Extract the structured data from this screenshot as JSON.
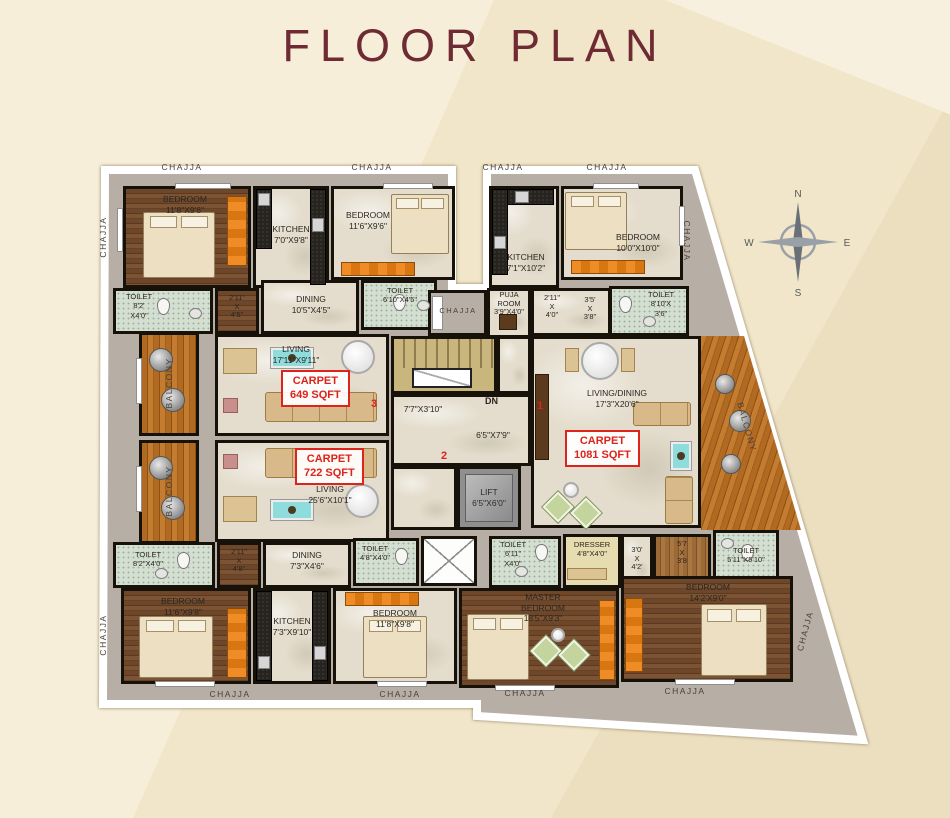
{
  "page": {
    "title": "FLOOR PLAN"
  },
  "labels": {
    "chajja": "CHAJJA",
    "balcony": "BALCONY"
  },
  "compass": {
    "n": "N",
    "e": "E",
    "s": "S",
    "w": "W"
  },
  "core": {
    "dn": "DN",
    "lift_name": "LIFT",
    "lift_dims": "6'5\"X6'0\"",
    "lobby1": "7'7\"X3'10\"",
    "lobby2": "6'5\"X7'9\"",
    "unit1": "1",
    "unit2": "2",
    "unit3": "3"
  },
  "carpets": {
    "u3": {
      "l1": "CARPET",
      "l2": "649 SQFT"
    },
    "u2": {
      "l1": "CARPET",
      "l2": "722 SQFT"
    },
    "u1": {
      "l1": "CARPET",
      "l2": "1081 SQFT"
    }
  },
  "rooms": {
    "bedroom_tl1": {
      "name": "BEDROOM",
      "dims": "11'8\"X9'6\""
    },
    "kitchen_tl": {
      "name": "KITCHEN",
      "dims": "7'0\"X9'8\""
    },
    "bedroom_tl2": {
      "name": "BEDROOM",
      "dims": "11'6\"X9'6\""
    },
    "toilet_tl1": {
      "name": "TOILET",
      "d1": "8'2'",
      "d2": "X4'0\""
    },
    "passage_tl": {
      "a": "2'11\"",
      "b": "X",
      "c": "4'5\""
    },
    "dining_tl": {
      "name": "DINING",
      "dims": "10'5\"X4'5\""
    },
    "toilet_tl2": {
      "name": "TOILET",
      "dims": "6'10\"X4'5\""
    },
    "living_u3": {
      "name": "LIVING",
      "dims": "17'11\"X9'11\""
    },
    "living_u2": {
      "name": "LIVING",
      "dims": "25'6\"X10'1\""
    },
    "kitchen_tr": {
      "name": "KITCHEN",
      "dims": "7'1\"X10'2\""
    },
    "bedroom_tr": {
      "name": "BEDROOM",
      "dims": "10'0\"X10'0\""
    },
    "puja": {
      "l1": "PUJA",
      "l2": "ROOM",
      "l3": "3'9\"X4'0\""
    },
    "passage_tr1": {
      "a": "2'11\"",
      "b": "X",
      "c": "4'0\""
    },
    "passage_tr2": {
      "a": "3'5'",
      "b": "X",
      "c": "3'8\""
    },
    "toilet_tr": {
      "name": "TOILET",
      "d1": "8'10'X",
      "d2": "3'6\""
    },
    "living_u1": {
      "name": "LIVING/DINING",
      "dims": "17'3\"X20'6\""
    },
    "toilet_r": {
      "name": "TOILET",
      "dims": "5'11\"X5'10\""
    },
    "toilet_bl": {
      "name": "TOILET",
      "dims": "8'2\"X4'0\""
    },
    "passage_bl": {
      "a": "2'11\"",
      "b": "X",
      "c": "4'8\""
    },
    "dining_bl": {
      "name": "DINING",
      "dims": "7'3\"X4'6\""
    },
    "toilet_bm1": {
      "name": "TOILET",
      "dims": "4'8\"X4'0\""
    },
    "toilet_bm2": {
      "name": "TOILET",
      "d1": "6'11\"",
      "d2": "X4'0\""
    },
    "dresser": {
      "name": "DRESSER",
      "dims": "4'8\"X4'0\""
    },
    "passage_br1": {
      "a": "3'0'",
      "b": "X",
      "c": "4'2'"
    },
    "passage_br2": {
      "a": "5'7",
      "b": "X",
      "c": "3'8"
    },
    "bedroom_bl1": {
      "name": "BEDROOM",
      "dims": "11'6\"X9'8\""
    },
    "kitchen_b": {
      "name": "KITCHEN",
      "dims": "7'3\"X9'10\""
    },
    "bedroom_bl2": {
      "name": "BEDROOM",
      "dims": "11'8\"X9'8\""
    },
    "master": {
      "l1": "MASTER",
      "l2": "BEDROOM",
      "l3": "18'5\"X9'3\""
    },
    "bedroom_br": {
      "name": "BEDROOM",
      "dims": "14'2'X9'0\""
    }
  },
  "colors": {
    "page_bg": "#f1e6c9",
    "title": "#6f2b34",
    "accent_red": "#dc231c",
    "wall": "#161209",
    "chajja_grey": "#b7aea6",
    "marble": "#e4ddcd",
    "bedroom_wood": "#6e472a",
    "balcony_wood": "#b06a22",
    "toilet_floor": "#d5dfd1",
    "wardrobe_orange": "#ef8c25"
  }
}
